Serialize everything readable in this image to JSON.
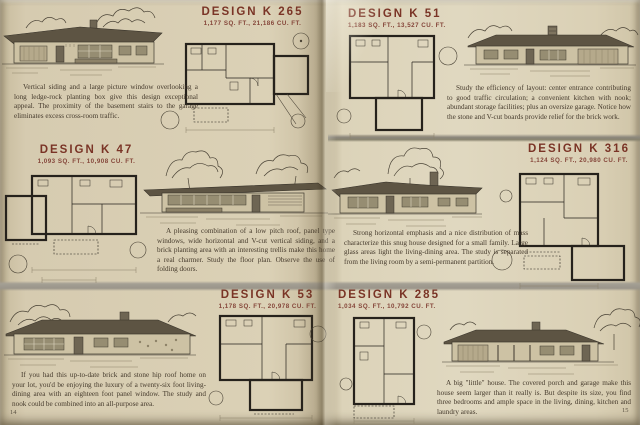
{
  "page": {
    "left_number": "14",
    "right_number": "15"
  },
  "colors": {
    "paper": "#d9cfb4",
    "title_red": "#7a3426",
    "ink": "#453a2c",
    "band_gray": "#9a958a"
  },
  "designs": [
    {
      "id": "k265",
      "title": "DESIGN K 265",
      "specs": "1,177 SQ. FT., 21,186 CU. FT.",
      "description": "Vertical siding and a large picture window overlooking a long ledge-rock planting box give this design exceptional appeal. The proximity of the basement stairs to the garage eliminates excess cross-room traffic."
    },
    {
      "id": "k51",
      "title": "DESIGN K 51",
      "specs": "1,183 SQ. FT., 13,527 CU. FT.",
      "description": "Study the efficiency of layout: center entrance contributing to good traffic circulation; a convenient kitchen with nook; abundant storage facilities; plus an oversize garage. Notice how the stone and V-cut boards provide relief for the brick work."
    },
    {
      "id": "k47",
      "title": "DESIGN K 47",
      "specs": "1,093 SQ. FT., 10,908 CU. FT.",
      "description": "A pleasing combination of a low pitch roof, panel type windows, wide horizontal and V-cut vertical siding, and a brick planting area with an interesting trellis make this home a real charmer. Study the floor plan. Observe the use of folding doors."
    },
    {
      "id": "k316",
      "title": "DESIGN K 316",
      "specs": "1,124 SQ. FT., 20,980 CU. FT.",
      "description": "Strong horizontal emphasis and a nice distribution of mass characterize this snug house designed for a small family. Large glass areas light the living-dining area. The study is separated from the living room by a semi-permanent partition."
    },
    {
      "id": "k53",
      "title": "DESIGN K 53",
      "specs": "1,178 SQ. FT., 20,978 CU. FT.",
      "description": "If you had this up-to-date brick and stone hip roof home on your lot, you'd be enjoying the luxury of a twenty-six foot living-dining area with an eighteen foot panel window. The study and nook could be combined into an all-purpose area."
    },
    {
      "id": "k285",
      "title": "DESIGN K 285",
      "specs": "1,034 SQ. FT., 10,792 CU. FT.",
      "description": "A big \"little\" house. The covered porch and garage make this house seem larger than it really is. But despite its size, you find three bedrooms and ample space in the living, dining, kitchen and laundry areas."
    }
  ]
}
